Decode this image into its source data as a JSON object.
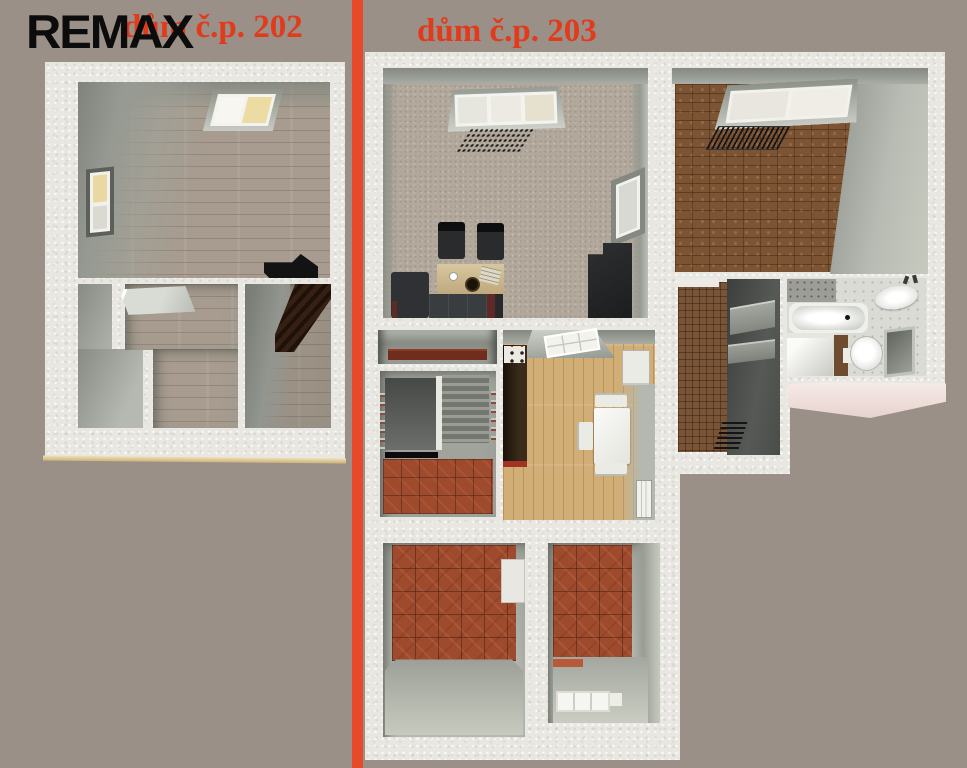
{
  "header": {
    "logo_text": "REMAX",
    "left_house_label": "dům č.p. 202",
    "right_house_label": "dům č.p. 203"
  },
  "colors": {
    "background": "#9a9088",
    "divider": "#e7492b",
    "label_text": "#e23a1b",
    "logo_text": "#0c0c0c",
    "plaster_wall": "#e9e7e1",
    "slab_edge_cream": "#e3d2a0",
    "terracotta_floor": "#9e4a2d",
    "parquet_floor": "#7c5433",
    "pine_floor": "#d2ae77",
    "carpet_floor": "#b2a89b",
    "wood_floor_202": "#a79c8f",
    "roof_pink": "#f0ded9"
  }
}
